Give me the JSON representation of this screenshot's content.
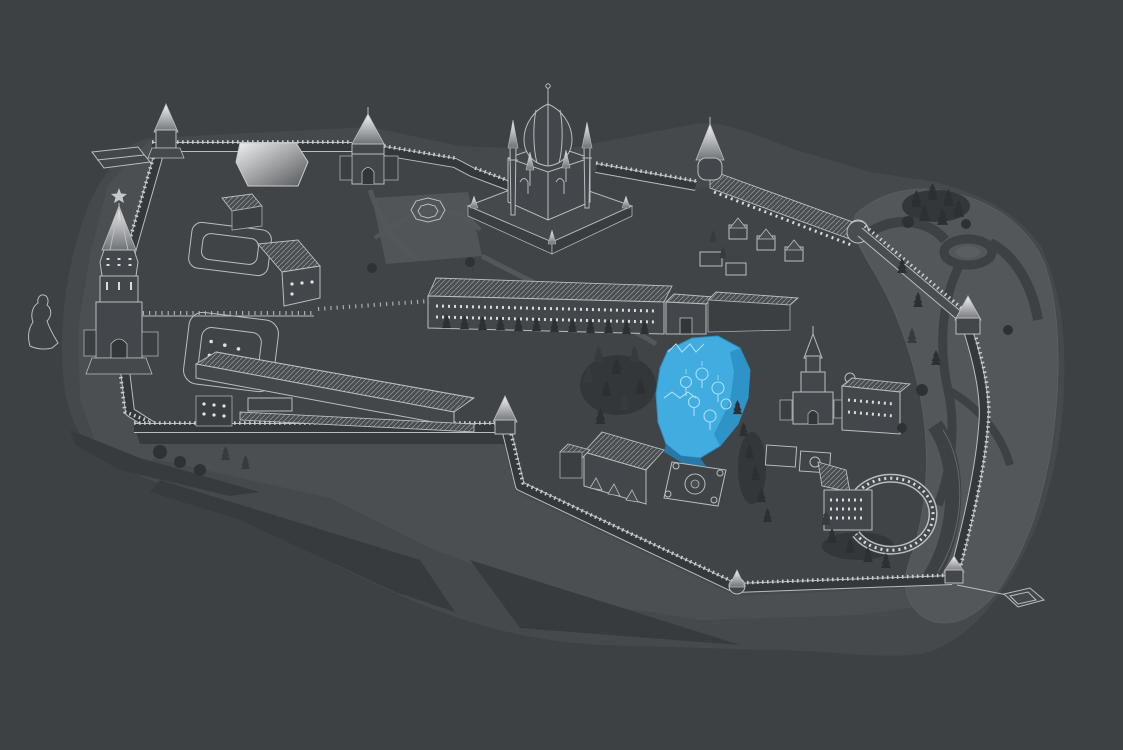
{
  "scene": {
    "type": "isometric-fortress-site-map",
    "description": "Dark line-art aerial map of a walled kremlin complex with one building highlighted in blue",
    "colors": {
      "background": "#3E4144",
      "terrain_outer": "#46494C",
      "terrain_band": "#4C4F52",
      "terrain_light": "#54575A",
      "interior": "#414447",
      "slope_shadow": "#383B3E",
      "road": "#3E4144",
      "line_art": "#B9BDC0",
      "line_bright": "#EDEFF1",
      "building_fill": "#43464A",
      "tree_dark": "#2D3033",
      "bush": "#2F3235"
    },
    "highlight": {
      "id": "highlighted-cathedral",
      "fill": "#41ACDF",
      "shade": "#2E93C7",
      "base": "#2779A8",
      "detail_line": "#A9DFF6"
    },
    "landmarks": [
      {
        "id": "highlighted-cathedral",
        "kind": "selected-building",
        "highlighted": true
      },
      {
        "id": "mosque-with-minarets",
        "kind": "domed-mosque",
        "highlighted": false
      },
      {
        "id": "main-spired-tower",
        "kind": "gate-tower-with-star",
        "highlighted": false
      },
      {
        "id": "north-gate-tower",
        "kind": "gate-tower",
        "highlighted": false
      },
      {
        "id": "leaning-tower",
        "kind": "tiered-tower",
        "highlighted": false
      },
      {
        "id": "long-administrative-building",
        "kind": "building",
        "highlighted": false
      },
      {
        "id": "riding-hall",
        "kind": "building",
        "highlighted": false
      },
      {
        "id": "governor-palace",
        "kind": "building",
        "highlighted": false
      },
      {
        "id": "semicircular-building",
        "kind": "building",
        "highlighted": false
      },
      {
        "id": "archbishop-house",
        "kind": "building",
        "highlighted": false
      },
      {
        "id": "fortress-wall-ring",
        "kind": "crenellated-wall-with-towers",
        "highlighted": false
      },
      {
        "id": "roundabout",
        "kind": "road-circle",
        "highlighted": false
      },
      {
        "id": "monument-statue",
        "kind": "statue-outline",
        "highlighted": false
      }
    ]
  }
}
